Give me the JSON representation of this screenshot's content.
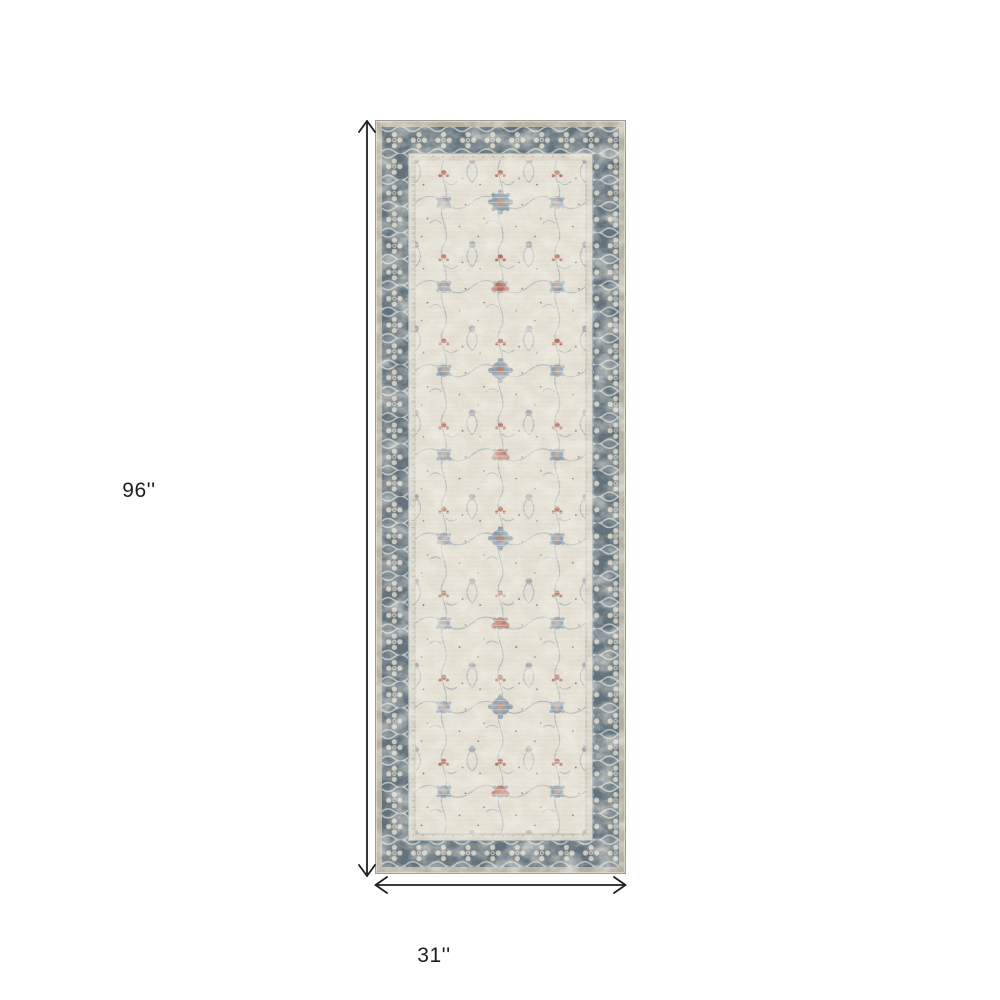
{
  "page": {
    "background": "#ffffff"
  },
  "diagram": {
    "type": "product-dimension-diagram",
    "product_description": "Distressed vintage Persian-style runner rug with slate blue ornate border and ivory floral field",
    "height_label": "96''",
    "width_label": "31''",
    "height_inches": 96,
    "width_inches": 31
  },
  "colors": {
    "page-background": "#ffffff",
    "line-color": "#1f1f1f",
    "label-color": "#1c1c1c",
    "rug-outer-beige": "#b7b0a3",
    "rug-border-slate": "#5f6f7a",
    "rug-guard-cream": "#dbd5c6",
    "rug-field-ivory": "#e5e0d2",
    "rug-motif-blue": "#8b9caa",
    "rug-motif-rust": "#b5705e"
  }
}
